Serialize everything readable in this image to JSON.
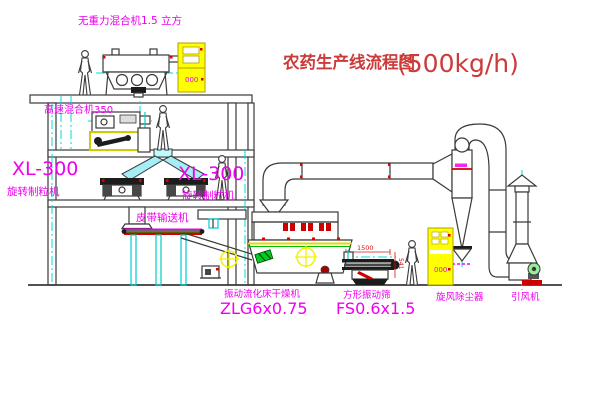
{
  "title": {
    "text": "农药生产线流程图",
    "capacity": "(500kg/h)"
  },
  "equipment": {
    "gravity_mixer": "无重力混合机1.5 立方",
    "high_speed_mixer": "高速混合机350",
    "left_granulator": {
      "model": "XL-300",
      "name": "旋转制粒机"
    },
    "center_granulator": {
      "model": "XL-300",
      "name": "旋转制粒机"
    },
    "belt_conveyor": "皮带输送机",
    "fluid_bed_dryer": {
      "name": "振动流化床干燥机",
      "model": "ZLG6x0.75"
    },
    "square_screen": {
      "name": "方形振动筛",
      "model": "FS0.6x1.5"
    },
    "cyclone": "旋风除尘器",
    "induced_draft_fan": "引风机"
  },
  "dimensions": {
    "screen_length": "1500",
    "screen_height": "541"
  },
  "cabinet_marks": {
    "top_cabinet": "000",
    "right_cabinet": "000"
  },
  "colors": {
    "label_magenta": "#ee00ee",
    "title_red": "#cc3a3a",
    "dimension_red": "#dd1111",
    "centerline_cyan": "#00d8d8",
    "equipment_yellow": "#ffff00",
    "accent_green": "#00bb00",
    "line_dark": "#3a3a3a"
  }
}
